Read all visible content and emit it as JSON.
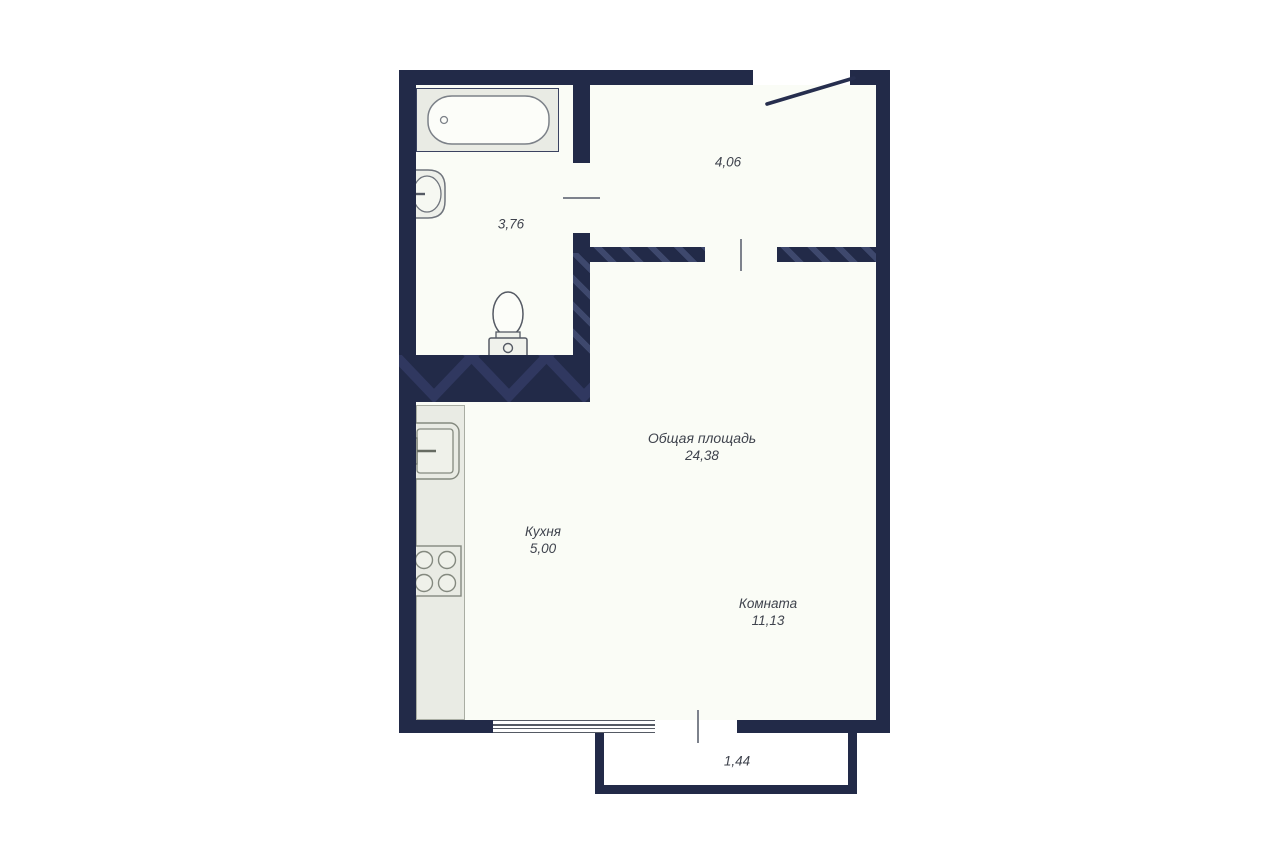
{
  "title": "apartment-floor-plan",
  "rooms": {
    "bathroom": {
      "area": "3,76"
    },
    "hallway": {
      "area": "4,06"
    },
    "total": {
      "name": "Общая площадь",
      "area": "24,38"
    },
    "kitchen": {
      "name": "Кухня",
      "area": "5,00"
    },
    "living": {
      "name": "Комната",
      "area": "11,13"
    },
    "balcony": {
      "area": "1,44"
    }
  },
  "fixtures": [
    "bathtub-icon",
    "bathroom-sink-icon",
    "toilet-icon",
    "kitchen-sink-icon",
    "stove-icon",
    "entrance-door-icon",
    "window-icon"
  ],
  "colors": {
    "wall": "#222a48",
    "wall_hatch": "#2f3760",
    "floor": "#fafcf6",
    "fixture_fill": "#e9ebe4",
    "fixture_stroke": "#7c8188",
    "text": "#3f434d",
    "background": "#ffffff"
  }
}
